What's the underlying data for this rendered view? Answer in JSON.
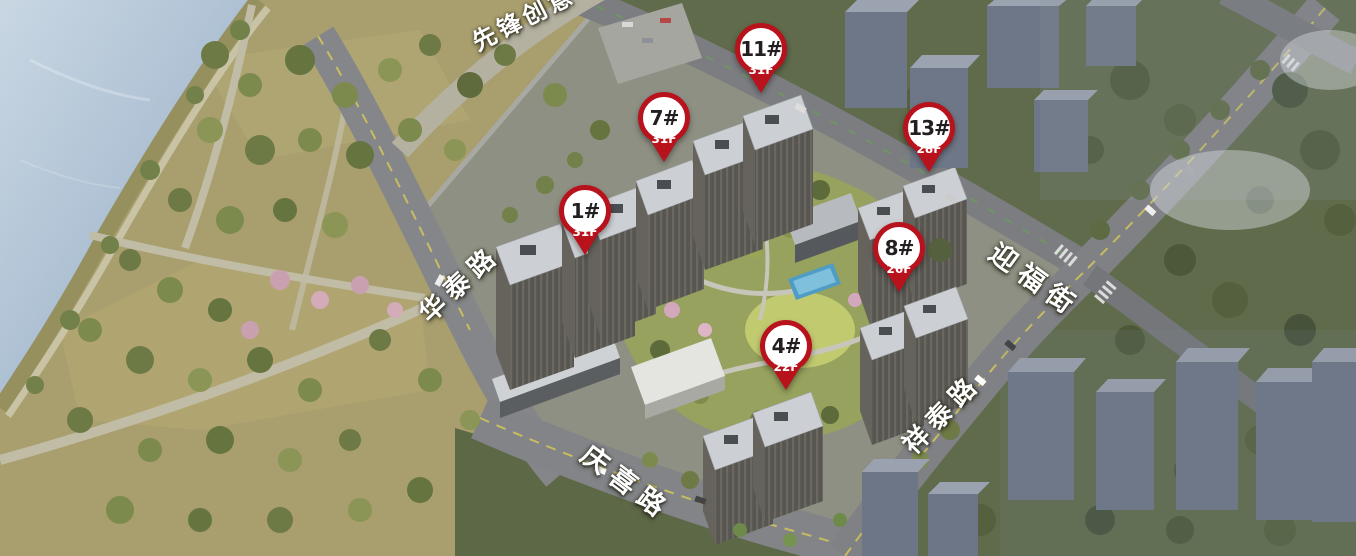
{
  "markers": [
    {
      "id": "1#",
      "floors": "31F",
      "x": 585,
      "y": 255
    },
    {
      "id": "4#",
      "floors": "22F",
      "x": 786,
      "y": 390
    },
    {
      "id": "7#",
      "floors": "31F",
      "x": 664,
      "y": 162
    },
    {
      "id": "8#",
      "floors": "26F",
      "x": 899,
      "y": 292
    },
    {
      "id": "11#",
      "floors": "31F",
      "x": 761,
      "y": 93
    },
    {
      "id": "13#",
      "floors": "28F",
      "x": 929,
      "y": 172
    }
  ],
  "streets": [
    {
      "name": "先锋创意",
      "x": 474,
      "y": 44,
      "rotate": -27,
      "size": 24,
      "spacing": 4
    },
    {
      "name": "华泰路",
      "x": 424,
      "y": 318,
      "rotate": -43,
      "size": 26,
      "spacing": 7
    },
    {
      "name": "迎福街",
      "x": 992,
      "y": 250,
      "rotate": 36,
      "size": 27,
      "spacing": 8
    },
    {
      "name": "祥泰路",
      "x": 908,
      "y": 450,
      "rotate": -46,
      "size": 26,
      "spacing": 7
    },
    {
      "name": "庆喜路",
      "x": 584,
      "y": 452,
      "rotate": 37,
      "size": 27,
      "spacing": 8
    }
  ],
  "colors": {
    "marker_red": "#b8121c",
    "marker_number": "#231f20",
    "marker_floor_text": "#ffffff",
    "street_label": "#ffffff"
  }
}
